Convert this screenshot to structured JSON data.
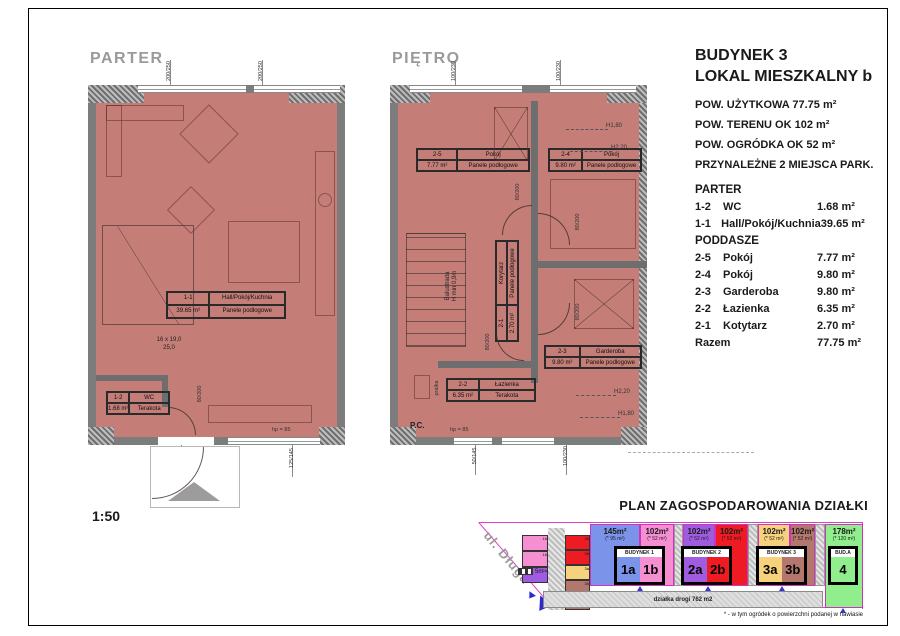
{
  "sheet": {
    "scale": "1:50"
  },
  "legend": {
    "building": "BUDYNEK 3",
    "unit": "LOKAL MIESZKALNY b",
    "specs": [
      "POW. UŻYTKOWA   77.75 m²",
      "POW. TERENU  OK 102 m²",
      "POW.  OGRÓDKA  OK 52 m²",
      "PRZYNALEŻNE 2 MIEJSCA PARK."
    ],
    "schedule": {
      "section1": "PARTER",
      "rows1": [
        {
          "id": "1-2",
          "name": "WC",
          "area": "1.68 m²"
        },
        {
          "id": "1-1",
          "name": "Hall/Pokój/Kuchnia",
          "area": "39.65 m²"
        }
      ],
      "section2": "PODDASZE",
      "rows2": [
        {
          "id": "2-5",
          "name": "Pokój",
          "area": "7.77 m²"
        },
        {
          "id": "2-4",
          "name": "Pokój",
          "area": "9.80 m²"
        },
        {
          "id": "2-3",
          "name": "Garderoba",
          "area": "9.80 m²"
        },
        {
          "id": "2-2",
          "name": "Łazienka",
          "area": "6.35 m²"
        },
        {
          "id": "2-1",
          "name": "Kotytarz",
          "area": "2.70 m²"
        }
      ],
      "total_label": "Razem",
      "total_value": "77.75 m²"
    }
  },
  "plans": {
    "parter": {
      "title": "PARTER",
      "rooms": {
        "hall": {
          "id": "1-1",
          "name": "Hall/Pokój/Kuchnia",
          "area": "39.65 m²",
          "floor": "Panele podłogowe"
        },
        "wc": {
          "id": "1-2",
          "name": "WC",
          "area": "1.68 m²",
          "floor": "Terakota"
        }
      },
      "stairs_note1": "16 x 19,0",
      "stairs_note2": "25,0",
      "dims": {
        "top1": "200/250",
        "top2": "200/250",
        "door_wc": "80/200",
        "entry": "90/205",
        "window_bottom": "125/145",
        "hp": "hp = 85"
      }
    },
    "pietro": {
      "title": "PIĘTRO",
      "rooms": {
        "p25": {
          "id": "2-5",
          "name": "Pokój",
          "area": "7.77 m²",
          "floor": "Panele podłogowe"
        },
        "p24": {
          "id": "2-4",
          "name": "Pokój",
          "area": "9.80 m²",
          "floor": "Panele podłogowe"
        },
        "gard": {
          "id": "2-3",
          "name": "Garderoba",
          "area": "9.80 m²",
          "floor": "Panele podłogowe"
        },
        "laz": {
          "id": "2-2",
          "name": "Łazienka",
          "area": "6.35 m²",
          "floor": "Terakota"
        },
        "kory": {
          "id": "2-1",
          "name": "Korytarz",
          "area": "2.70 m²",
          "floor": "Panele podłogowe"
        }
      },
      "labels": {
        "balustrada1": "Balustrada",
        "balustrada2": "H min 0,9m",
        "pc": "P.C.",
        "pralka": "pralka",
        "h180": "H1,80",
        "h220": "H2,20"
      },
      "dims": {
        "top1": "100/230",
        "top2": "100/230",
        "door": "80/200",
        "bottom1": "50/145",
        "bottom2": "100/230",
        "hp": "hp = 85"
      }
    }
  },
  "site": {
    "title": "PLAN ZAGOSPODAROWANIA DZIAŁKI",
    "street": "ul. Długa",
    "road": "działka drogi 762 m2",
    "footnote": "* - w tym ogródek o powierzchni podanej w nawiasie",
    "scale_marker": "5m",
    "plots": [
      {
        "area": "145m²",
        "garden": "(* 95 m²)",
        "color": "#7b94ea"
      },
      {
        "area": "102m²",
        "garden": "(* 52 m²)",
        "color": "#f58fd2"
      },
      {
        "area": "102m²",
        "garden": "(* 52 m²)",
        "color": "#a05ce0"
      },
      {
        "area": "102m²",
        "garden": "(* 52 m²)",
        "color": "#ee1b23"
      },
      {
        "area": "102m²",
        "garden": "(* 52 m²)",
        "color": "#f6d27d"
      },
      {
        "area": "102m²",
        "garden": "(* 52 m²)",
        "color": "#b4776e"
      },
      {
        "area": "178m²",
        "garden": "(* 120 m²)",
        "color": "#90ee8c"
      }
    ],
    "buildings": [
      {
        "name": "BUDYNEK 1",
        "units": [
          "1a",
          "1b"
        ]
      },
      {
        "name": "BUDYNEK 2",
        "units": [
          "2a",
          "2b"
        ]
      },
      {
        "name": "BUDYNEK 3",
        "units": [
          "3a",
          "3b"
        ]
      },
      {
        "name": "BUD.A",
        "units": [
          "4"
        ]
      }
    ],
    "parking_left": [
      "1b",
      "1b",
      "2a"
    ],
    "parking_right": [
      "2b",
      "2b",
      "3a",
      "3b",
      "3b"
    ],
    "colors": {
      "boundary": "#df3cc9",
      "plan_fill": "#c57d78",
      "wall": "#7c7c7c"
    }
  }
}
